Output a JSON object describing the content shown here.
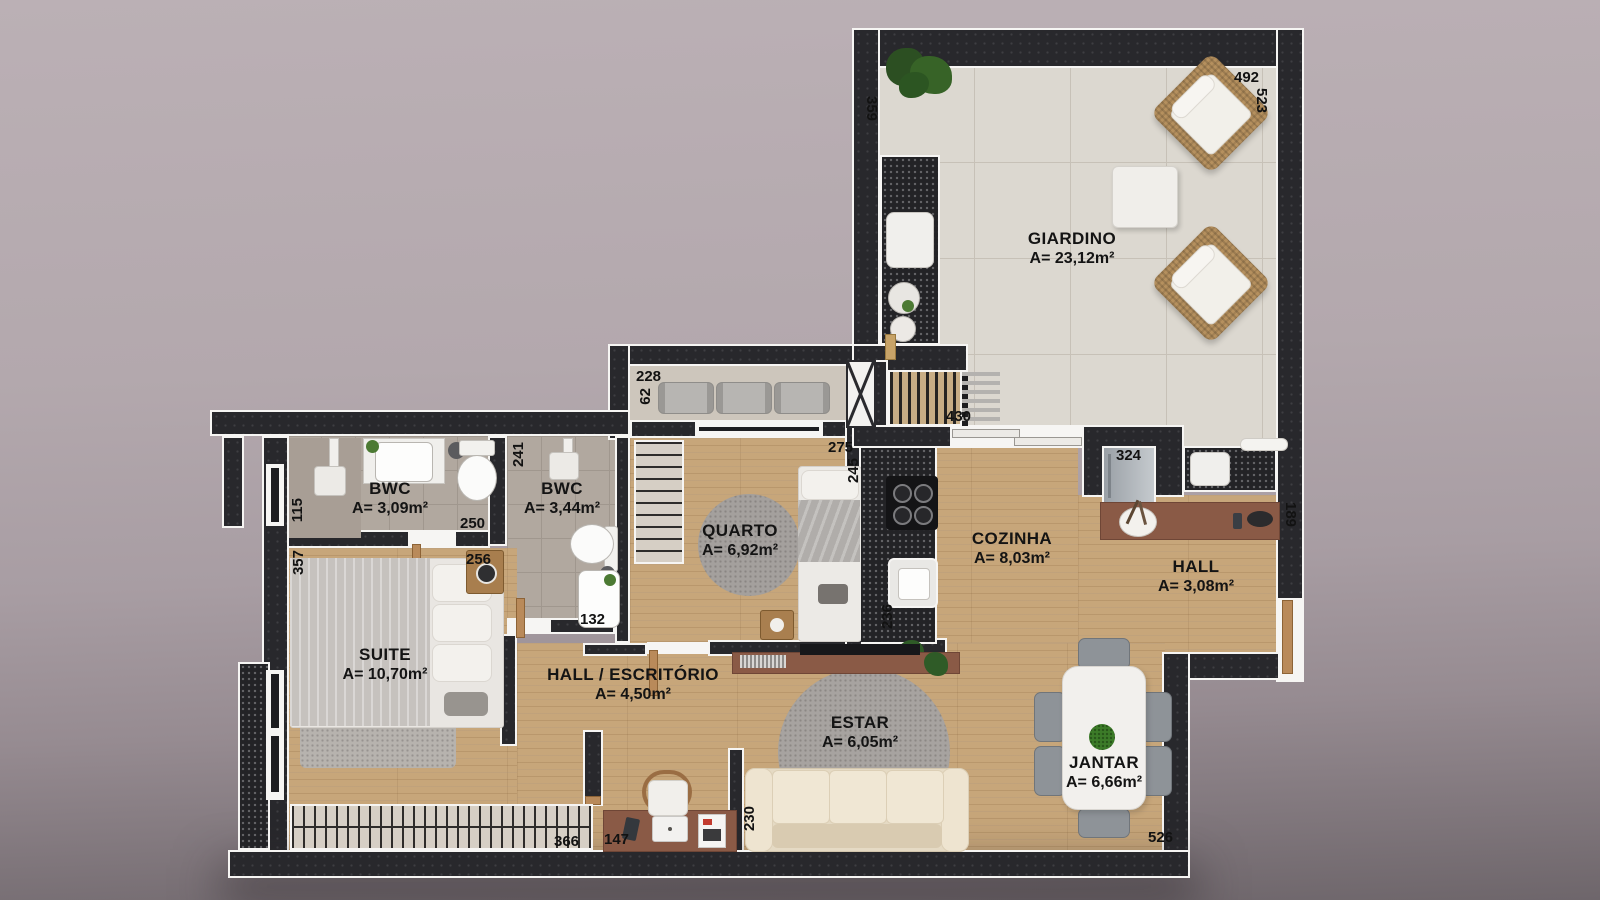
{
  "title": "Apartment floor plan",
  "rooms": {
    "giardino": {
      "name": "GIARDINO",
      "area": "A= 23,12m²"
    },
    "bwc1": {
      "name": "BWC",
      "area": "A= 3,09m²"
    },
    "bwc2": {
      "name": "BWC",
      "area": "A= 3,44m²"
    },
    "quarto": {
      "name": "QUARTO",
      "area": "A= 6,92m²"
    },
    "cozinha": {
      "name": "COZINHA",
      "area": "A= 8,03m²"
    },
    "hall": {
      "name": "HALL",
      "area": "A= 3,08m²"
    },
    "suite": {
      "name": "SUITE",
      "area": "A= 10,70m²"
    },
    "hall_escritorio": {
      "name": "HALL / ESCRITÓRIO",
      "area": "A= 4,50m²"
    },
    "estar": {
      "name": "ESTAR",
      "area": "A= 6,05m²"
    },
    "jantar": {
      "name": "JANTAR",
      "area": "A= 6,66m²"
    }
  },
  "dimensions_cm": {
    "d492": "492",
    "d523": "523",
    "d359": "359",
    "d228": "228",
    "d62": "62",
    "d430": "430",
    "d275": "275",
    "d245": "245",
    "d324": "324",
    "d189": "189",
    "d115": "115",
    "d250": "250",
    "d241": "241",
    "d256": "256",
    "d357": "357",
    "d132": "132",
    "d236": "236",
    "d366": "366",
    "d147": "147",
    "d230": "230",
    "d526": "526"
  },
  "colors": {
    "wall": "#28282c",
    "outline": "#f6f5f3",
    "wood_floor": "#c7a67a",
    "tile_floor": "#dcd8d0",
    "bathroom_tile": "#b1a89f",
    "furniture_wood": "#8a5a46",
    "background": "#b2a8ad",
    "label_text": "#141414"
  }
}
